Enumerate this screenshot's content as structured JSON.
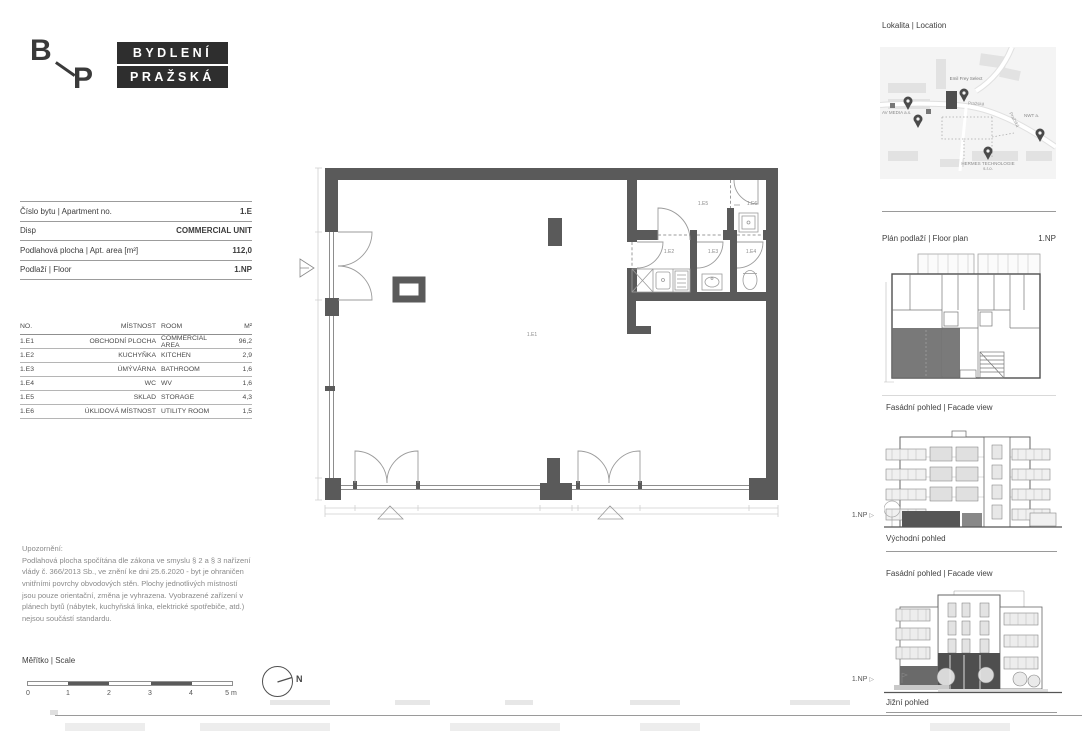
{
  "logo": {
    "b": "B",
    "p": "P",
    "line1": "BYDLENÍ",
    "line2": "PRAŽSKÁ"
  },
  "info_table": {
    "rows": [
      {
        "label": "Číslo bytu | Apartment no.",
        "value": "1.E"
      },
      {
        "label": "Disp",
        "value": "COMMERCIAL UNIT"
      },
      {
        "label": "Podlahová plocha | Apt. area [m²]",
        "value": "112,0"
      },
      {
        "label": "Podlaží | Floor",
        "value": "1.NP"
      }
    ]
  },
  "rooms_table": {
    "headers": {
      "no": "NO.",
      "cz": "MÍSTNOST",
      "en": "ROOM",
      "area": "M²"
    },
    "rows": [
      {
        "no": "1.E1",
        "cz": "OBCHODNÍ PLOCHA",
        "en": "COMMERCIAL AREA",
        "area": "96,2"
      },
      {
        "no": "1.E2",
        "cz": "KUCHYŇKA",
        "en": "KITCHEN",
        "area": "2,9"
      },
      {
        "no": "1.E3",
        "cz": "ÚMÝVÁRNA",
        "en": "BATHROOM",
        "area": "1,6"
      },
      {
        "no": "1.E4",
        "cz": "WC",
        "en": "WV",
        "area": "1,6"
      },
      {
        "no": "1.E5",
        "cz": "SKLAD",
        "en": "STORAGE",
        "area": "4,3"
      },
      {
        "no": "1.E6",
        "cz": "ÚKLIDOVÁ MÍSTNOST",
        "en": "UTILITY ROOM",
        "area": "1,5"
      }
    ]
  },
  "disclaimer": {
    "title": "Upozornění:",
    "body": "Podlahová plocha spočítána dle zákona ve smyslu § 2 a § 3 nařízení vlády č. 366/2013 Sb., ve znění ke dni 25.6.2020 - byt je ohraničen vnitřními povrchy obvodových stěn. Plochy jednotlivých místností jsou pouze orientační, změna je vyhrazena. Vyobrazené zařízení v plánech bytů (nábytek, kuchyňská linka, elektrické spotřebiče, atd.) nejsou součástí standardu."
  },
  "scale": {
    "title": "Měřítko | Scale",
    "ticks": [
      "0",
      "1",
      "2",
      "3",
      "4",
      "5 m"
    ]
  },
  "north": {
    "label": "N"
  },
  "plan": {
    "labels": {
      "e1": "1.E1",
      "e2": "1.E2",
      "e3": "1.E3",
      "e4": "1.E4",
      "e5": "1.E5",
      "e6": "1.E6"
    }
  },
  "sidebar": {
    "location": {
      "title": "Lokalita | Location",
      "map_labels": {
        "emil": "Emil Frey Select",
        "avmedia": "AV MEDIA a.s.",
        "nwt": "NWT a.",
        "hermes": "HERMES TECHNOLOGIE s.r.o.",
        "street1": "Pražská",
        "street2": "Pražská"
      }
    },
    "floor_plan": {
      "title": "Plán podlaží | Floor plan",
      "floor": "1.NP"
    },
    "facade_east": {
      "title": "Fasádní pohled | Facade view",
      "marker": "1.NP",
      "pointer": "▷",
      "caption": "Východní pohled"
    },
    "facade_south": {
      "title": "Fasádní pohled | Facade view",
      "marker": "1.NP",
      "pointer": "▷",
      "caption": "Jižní pohled"
    }
  },
  "colors": {
    "wall": "#5a5a5a",
    "logo_box": "#2e2e2e",
    "highlight_unit": "#6e6e6e"
  }
}
